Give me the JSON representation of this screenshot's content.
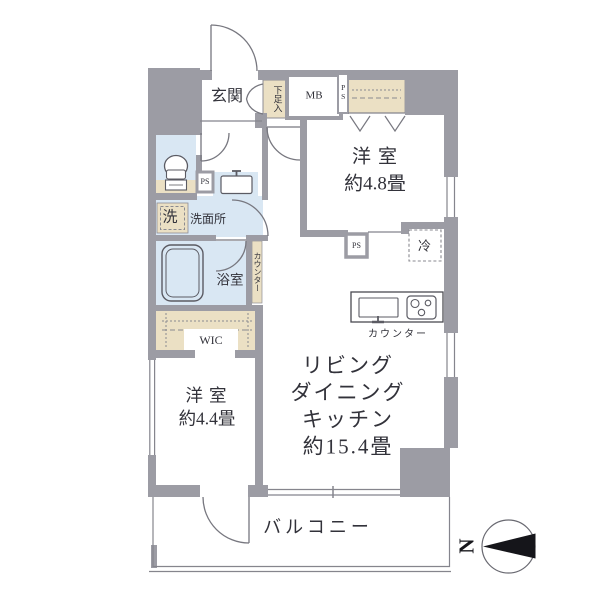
{
  "meta": {
    "type": "floor-plan",
    "country": "JP"
  },
  "colors": {
    "wall": "#9c9ca4",
    "storage_fill": "#ebe0c4",
    "water_fill": "#d9e7f3",
    "thin_line": "#85858d",
    "door_line": "#77777f",
    "fixture_line": "#5b5b63",
    "compass_fill": "#15151a"
  },
  "labels": {
    "genkan": "玄関",
    "shoe_storage": "下足入",
    "meter_box": "MB",
    "pipe_space_top": "PS",
    "room1_name": "洋室",
    "room1_size": "約4.8畳",
    "pipe_space_hall": "PS",
    "laundry": "洗",
    "washroom": "洗面所",
    "bathroom": "浴室",
    "side_counter": "カウンター",
    "wic": "WIC",
    "pipe_space_ldk": "PS",
    "refrigerator": "冷",
    "kitchen_counter": "カウンター",
    "ldk_line1": "リビング",
    "ldk_line2": "ダイニング",
    "ldk_line3": "キッチン",
    "ldk_size": "約15.4畳",
    "room2_name": "洋室",
    "room2_size": "約4.4畳",
    "balcony": "バルコニー",
    "compass_north": "N"
  },
  "icons": [
    "entrance-door-arc",
    "shoe-cabinet-doors",
    "toilet-icon",
    "sink-icon",
    "bathtub-icon",
    "closet-hanger-icons",
    "stove-icon",
    "kitchen-sink-icon",
    "refrigerator-dashed-box",
    "balcony-door-arc",
    "compass-icon"
  ]
}
